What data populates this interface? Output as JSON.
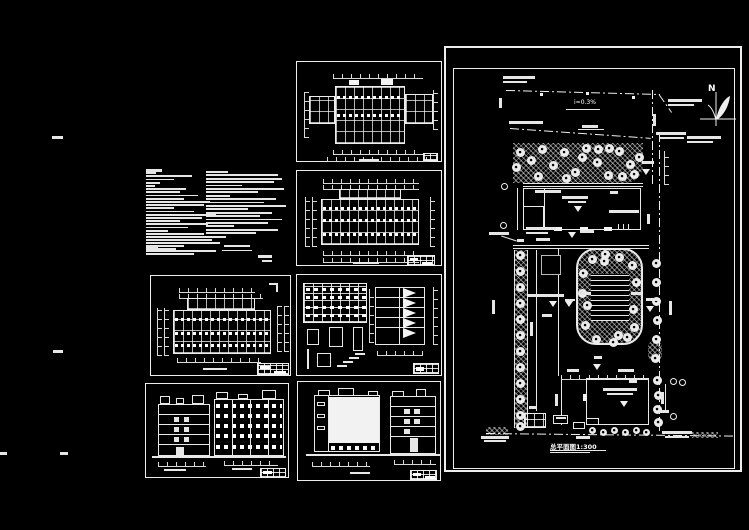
{
  "palette": {
    "background": "#000000",
    "ink": "#e8e8e8"
  },
  "site_plan": {
    "north_label": "N",
    "slope_label": "i=0.3%",
    "title": "总平面图1:300",
    "trees": {
      "band": {
        "r": 9,
        "pts": [
          [
            74,
            104
          ],
          [
            85,
            112
          ],
          [
            96,
            101
          ],
          [
            107,
            117
          ],
          [
            118,
            104
          ],
          [
            129,
            124
          ],
          [
            140,
            100
          ],
          [
            151,
            114
          ],
          [
            162,
            127
          ],
          [
            173,
            103
          ],
          [
            184,
            116
          ],
          [
            193,
            109
          ],
          [
            92,
            128
          ],
          [
            120,
            130
          ],
          [
            152,
            101
          ],
          [
            176,
            128
          ],
          [
            70,
            119
          ],
          [
            136,
            109
          ],
          [
            163,
            100
          ],
          [
            188,
            126
          ]
        ]
      },
      "left_strip": {
        "r": 9,
        "pts": [
          [
            74,
            207
          ],
          [
            74,
            223
          ],
          [
            74,
            239
          ],
          [
            74,
            255
          ],
          [
            74,
            271
          ],
          [
            74,
            287
          ],
          [
            74,
            303
          ],
          [
            74,
            319
          ],
          [
            74,
            335
          ],
          [
            74,
            351
          ],
          [
            74,
            367
          ],
          [
            74,
            378
          ]
        ]
      },
      "right_upper": {
        "r": 9,
        "pts": [
          [
            210,
            215
          ],
          [
            210,
            234
          ],
          [
            210,
            253
          ],
          [
            211,
            272
          ],
          [
            210,
            291
          ],
          [
            209,
            310
          ]
        ]
      },
      "right_lower": {
        "r": 9,
        "pts": [
          [
            211,
            332
          ],
          [
            212,
            347
          ],
          [
            211,
            361
          ],
          [
            212,
            374
          ]
        ]
      },
      "playground": {
        "r": 9,
        "pts": [
          [
            146,
            211
          ],
          [
            159,
            206
          ],
          [
            173,
            209
          ],
          [
            186,
            217
          ],
          [
            137,
            225
          ],
          [
            190,
            234
          ],
          [
            141,
            257
          ],
          [
            187,
            261
          ],
          [
            139,
            277
          ],
          [
            188,
            279
          ],
          [
            150,
            291
          ],
          [
            167,
            294
          ],
          [
            181,
            289
          ],
          [
            158,
            213
          ],
          [
            136,
            245
          ],
          [
            172,
            287
          ]
        ]
      },
      "bottom_row": {
        "r": 7,
        "pts": [
          [
            146,
            382
          ],
          [
            157,
            384
          ],
          [
            168,
            382
          ],
          [
            179,
            384
          ],
          [
            190,
            382
          ],
          [
            200,
            384
          ]
        ]
      }
    },
    "annotations": [
      [
        57,
        28,
        32,
        3
      ],
      [
        57,
        33,
        24,
        2
      ],
      [
        222,
        51,
        34,
        3
      ],
      [
        222,
        56,
        26,
        2
      ],
      [
        241,
        88,
        34,
        3
      ],
      [
        241,
        93,
        26,
        2
      ],
      [
        63,
        73,
        34,
        3
      ],
      [
        136,
        77,
        16,
        3
      ],
      [
        210,
        84,
        30,
        3
      ],
      [
        214,
        89,
        24,
        2
      ],
      [
        89,
        142,
        26,
        3
      ],
      [
        80,
        179,
        30,
        3
      ],
      [
        80,
        184,
        22,
        2
      ],
      [
        163,
        162,
        30,
        3
      ],
      [
        116,
        148,
        26,
        3
      ],
      [
        122,
        153,
        18,
        2
      ],
      [
        164,
        143,
        8,
        3
      ],
      [
        134,
        182,
        14,
        3
      ],
      [
        43,
        184,
        20,
        3
      ],
      [
        90,
        190,
        14,
        3
      ],
      [
        71,
        191,
        7,
        3
      ],
      [
        82,
        246,
        36,
        3
      ],
      [
        96,
        266,
        10,
        3
      ],
      [
        135,
        244,
        10,
        3
      ],
      [
        185,
        244,
        10,
        3
      ],
      [
        200,
        250,
        12,
        3
      ],
      [
        119,
        251,
        10,
        2
      ],
      [
        157,
        340,
        34,
        3
      ],
      [
        161,
        345,
        26,
        2
      ],
      [
        183,
        332,
        8,
        3
      ],
      [
        121,
        321,
        12,
        3
      ],
      [
        172,
        321,
        16,
        3
      ],
      [
        83,
        358,
        8,
        3
      ],
      [
        110,
        369,
        10,
        2
      ],
      [
        35,
        388,
        28,
        3
      ],
      [
        38,
        392,
        22,
        2
      ],
      [
        216,
        383,
        30,
        3
      ],
      [
        219,
        388,
        24,
        2
      ],
      [
        130,
        388,
        14,
        3
      ],
      [
        213,
        362,
        10,
        3
      ],
      [
        196,
        113,
        12,
        3
      ],
      [
        46,
        252,
        3,
        14
      ],
      [
        84,
        274,
        3,
        14
      ],
      [
        109,
        346,
        3,
        12
      ],
      [
        223,
        253,
        3,
        14
      ],
      [
        215,
        344,
        3,
        12
      ],
      [
        207,
        66,
        3,
        12
      ],
      [
        53,
        50,
        3,
        10
      ],
      [
        201,
        166,
        3,
        10
      ],
      [
        148,
        308,
        8,
        3
      ]
    ],
    "level_marks": [
      [
        132,
        158
      ],
      [
        126,
        184
      ],
      [
        107,
        253
      ],
      [
        123,
        253
      ],
      [
        204,
        258
      ],
      [
        178,
        353
      ],
      [
        200,
        121
      ],
      [
        151,
        316
      ]
    ],
    "axis_circles": [
      [
        58,
        138
      ],
      [
        57,
        177
      ],
      [
        227,
        333
      ],
      [
        227,
        368
      ],
      [
        236,
        334
      ]
    ]
  },
  "design_notes": {
    "col1": [
      16,
      10,
      46,
      28,
      14,
      9,
      40,
      34,
      52,
      38,
      64,
      58,
      28,
      48,
      70,
      56,
      34,
      62,
      42,
      22,
      11,
      28,
      20,
      9,
      12
    ],
    "col1_tail": [
      58,
      80,
      66,
      74,
      38,
      30,
      70,
      48
    ],
    "col2": [
      22,
      72,
      76,
      68,
      36,
      78,
      52,
      24,
      70,
      58,
      80,
      42,
      66,
      54,
      76,
      62,
      28,
      72,
      50,
      18
    ],
    "footer": [
      [
        78,
        78,
        26,
        2
      ],
      [
        76,
        83,
        30,
        1
      ],
      [
        112,
        88,
        14,
        3
      ],
      [
        116,
        93,
        10,
        2
      ]
    ]
  },
  "stray_marks": [
    [
      52,
      136,
      11,
      3
    ],
    [
      53,
      350,
      10,
      3
    ],
    [
      0,
      452,
      7,
      3
    ],
    [
      60,
      452,
      8,
      3
    ]
  ]
}
